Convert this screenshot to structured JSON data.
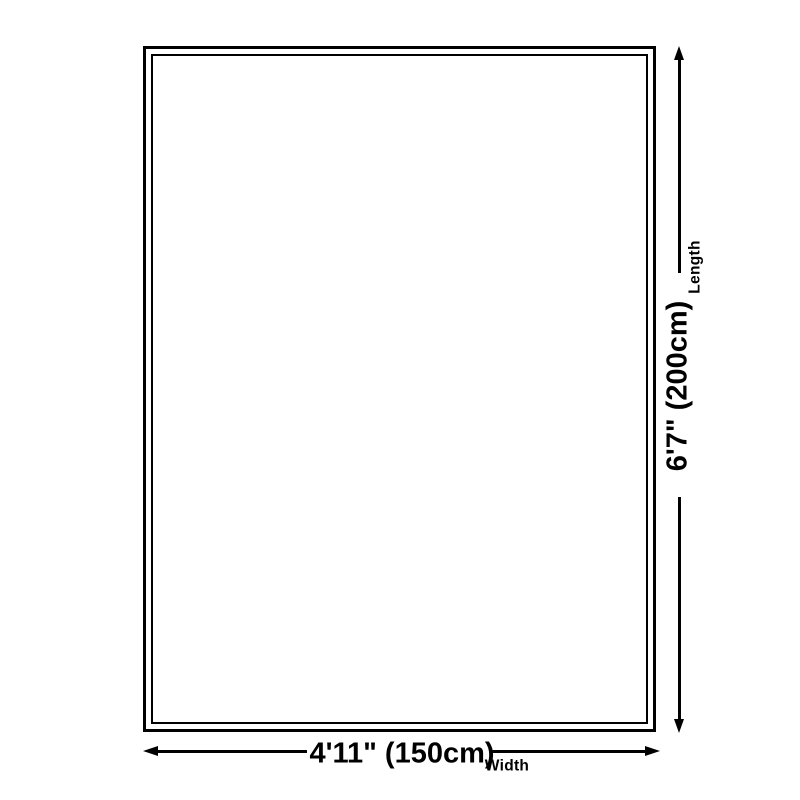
{
  "theme": {
    "background": "#ffffff",
    "line_color": "#000000",
    "text_color": "#000000"
  },
  "diagram": {
    "type": "product-dimension-diagram",
    "width_dimension": {
      "value": "4'11\" (150cm)",
      "label": "Width"
    },
    "length_dimension": {
      "value": "6'7\" (200cm)",
      "label": "Length"
    }
  }
}
